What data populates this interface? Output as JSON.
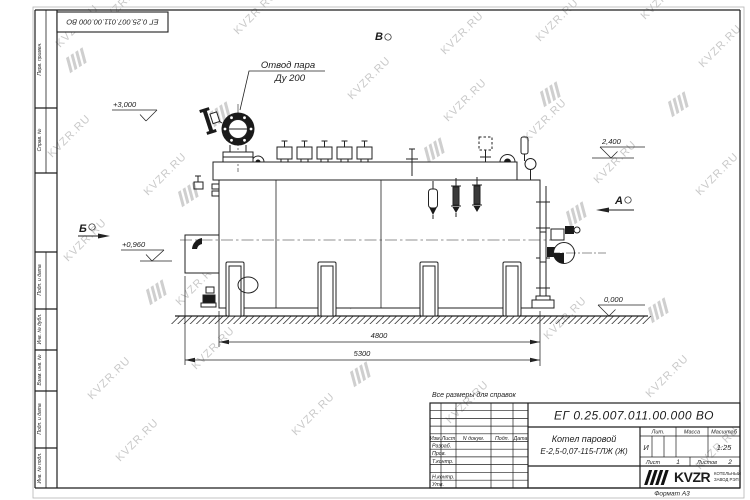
{
  "watermark": {
    "text": "KVZR.RU"
  },
  "frame": {
    "left_labels": [
      "Перв. примен.",
      "Справ. №",
      "Подп. и дата",
      "Инв. № дубл.",
      "Взам. инв. №",
      "Подп. и дата",
      "Инв. № подл."
    ],
    "format_note": "Формат А3"
  },
  "drawing": {
    "callout": {
      "line1": "Отвод пара",
      "line2": "Ду 200"
    },
    "elevations": {
      "valve_top": "+3,000",
      "boiler_top": "2,400",
      "left_mid": "+0,960",
      "ground": "0,000"
    },
    "dimensions": {
      "body_length": "4800",
      "overall_length": "5300"
    },
    "views": {
      "a": "А",
      "b": "Б",
      "v": "В"
    },
    "note": "Все размеры для справок"
  },
  "title_block": {
    "doc_number": "ЕГ 0.25.007.011.00.000 ВО",
    "product_line1": "Котел паровой",
    "product_line2": "Е-2,5-0,07-115-ГЛЖ (Ж)",
    "col_izm": "Изм.",
    "col_list": "Лист",
    "col_ndoc": "N докум.",
    "col_podp": "Подп.",
    "col_data": "Дата",
    "row_razrab": "Разраб.",
    "row_prov": "Пров.",
    "row_tkontr": "Т.контр.",
    "row_nkontr": "Н.контр.",
    "row_utv": "Утв.",
    "lit_label": "Лит.",
    "lit_value": "И",
    "mass_label": "Масса",
    "scale_label": "Масштаб",
    "scale_value": "1:25",
    "sheet_label": "Лист",
    "sheet_value": "1",
    "sheets_label": "Листов",
    "sheets_value": "2",
    "logo_text": "KVZR",
    "company_line1": "КОТЕЛЬНЫЙ",
    "company_line2": "ЗАВОД РЭП"
  }
}
